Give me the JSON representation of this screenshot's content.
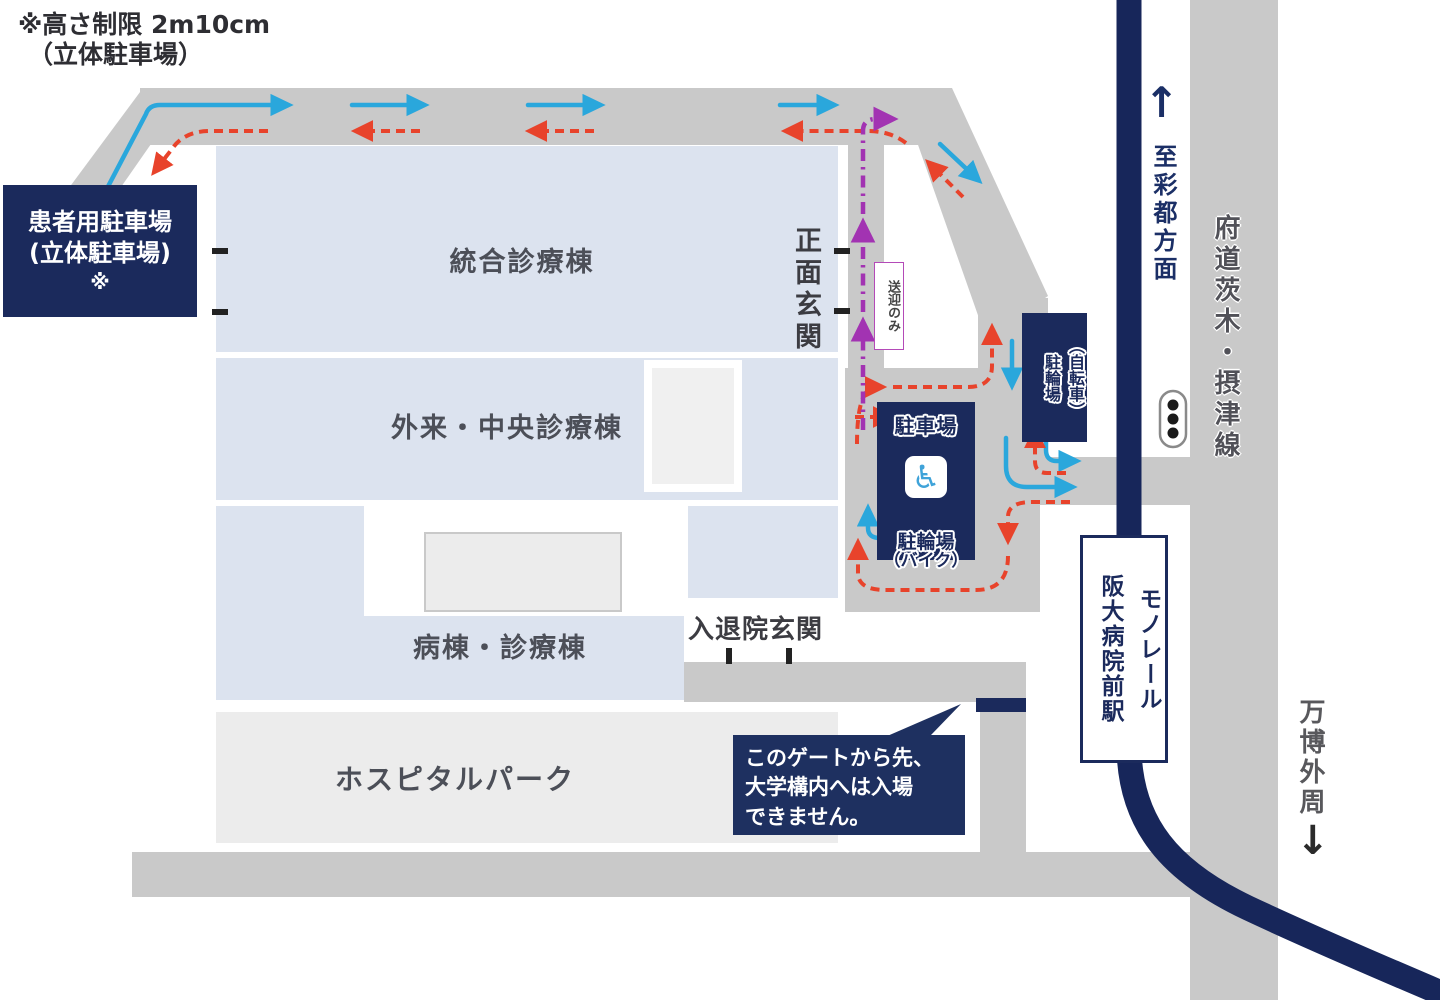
{
  "note": {
    "line1": "※高さ制限 2m10cm",
    "line2": "（立体駐車場）"
  },
  "patient_parking": {
    "line1": "患者用駐車場",
    "line2": "(立体駐車場)",
    "line3": "※"
  },
  "buildings": {
    "integrated_clinic": "統合診療棟",
    "outpatient_central": "外来・中央診療棟",
    "ward_clinic": "病棟・診療棟",
    "hospital_park": "ホスピタルパーク"
  },
  "entrances": {
    "main": "正面玄関",
    "admission_discharge": "入退院玄関",
    "dropoff_only": "送迎のみ"
  },
  "parking_box": {
    "car": "駐車場",
    "wheelchair_icon": "♿",
    "moto1": "駐輪場",
    "moto2": "（バイク）"
  },
  "bicycle_box": {
    "col_right": "（自転車）",
    "col_left": "駐輪場"
  },
  "station": {
    "col_right": "モノレール",
    "col_left": "阪大病院前駅"
  },
  "roadside": {
    "up_arrow": "↑",
    "to_saito": "至彩都方面",
    "prefectural_road": "府道茨木・摂津線",
    "expo_outer": "万博外周",
    "down_arrow": "↓"
  },
  "gate_bubble": {
    "line1": "このゲートから先、",
    "line2": "大学構内へは入場",
    "line3": "できません。"
  },
  "colors": {
    "navy_box": "#1B2A5C",
    "monorail_navy": "#17265A",
    "road_gray": "#C9C9C9",
    "building_fill": "#DCE3EF",
    "park_fill": "#ECECEC",
    "entry_blue": "#2AA7DC",
    "exit_red": "#E8432B",
    "dropoff_purple": "#A233B2"
  }
}
